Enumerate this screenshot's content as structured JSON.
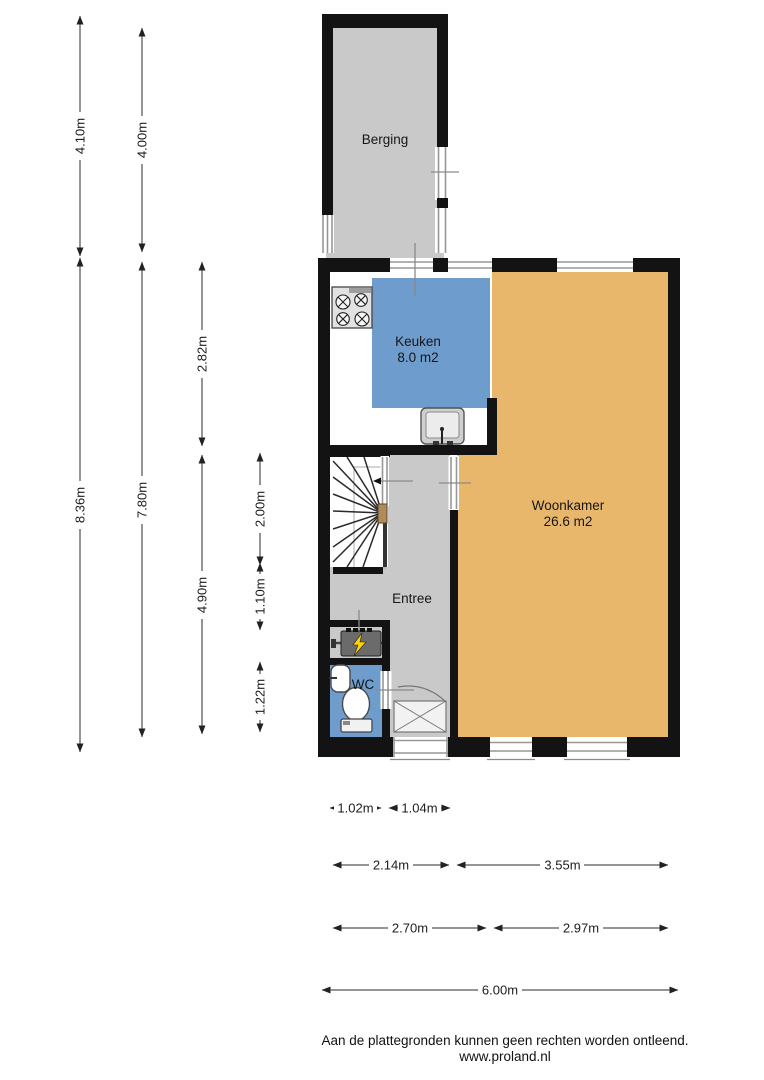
{
  "rooms": {
    "berging": {
      "label": "Berging"
    },
    "keuken": {
      "label": "Keuken",
      "area": "8.0 m2"
    },
    "woonkamer": {
      "label": "Woonkamer",
      "area": "26.6 m2"
    },
    "entree": {
      "label": "Entree"
    },
    "wc": {
      "label": "WC"
    }
  },
  "dimensions": {
    "columns": [
      {
        "segments": [
          "4.10m",
          "8.36m"
        ]
      },
      {
        "segments": [
          "4.00m",
          "7.80m"
        ]
      },
      {
        "segments": [
          "2.82m",
          "4.90m"
        ]
      },
      {
        "segments": [
          "2.00m",
          "1.10m",
          "1.22m"
        ]
      }
    ],
    "rows": [
      {
        "segments": [
          "1.02m",
          "1.04m"
        ]
      },
      {
        "segments": [
          "2.14m",
          "3.55m"
        ]
      },
      {
        "segments": [
          "2.70m",
          "2.97m"
        ]
      },
      {
        "segments": [
          "6.00m"
        ]
      }
    ]
  },
  "footer": {
    "disclaimer": "Aan de plattegronden kunnen geen rechten worden ontleend.",
    "website": "www.proland.nl"
  },
  "colors": {
    "wall": "#131313",
    "floor_gray": "#c9c9c9",
    "keuken_floor_blue": "#6e9dcd",
    "wc_floor_blue": "#6e9dcd",
    "woonkamer_floor_orange": "#e9b76c",
    "boiler_lightning_yellow": "#ffd500",
    "stair_newel_brown": "#b08b57"
  }
}
